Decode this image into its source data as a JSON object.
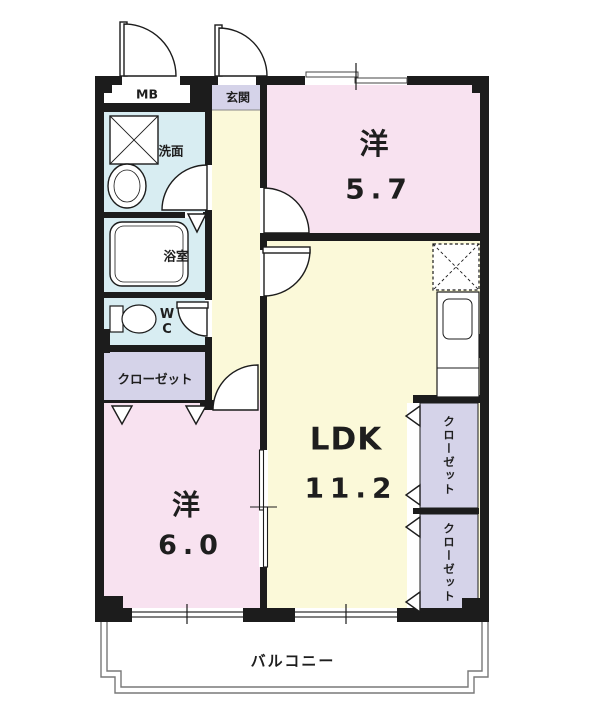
{
  "plan": {
    "title": "apartment floor plan",
    "rooms": {
      "bedroom_top": {
        "label": "洋",
        "size": "5.7"
      },
      "bedroom_bottom": {
        "label": "洋",
        "size": "6.0"
      },
      "ldk": {
        "label": "LDK",
        "size": "11.2"
      },
      "entrance": {
        "label": "玄関"
      },
      "washroom": {
        "label": "洗面"
      },
      "bathroom": {
        "label": "浴室"
      },
      "toilet": {
        "label": "W\nC"
      },
      "meter_box": {
        "label": "MB"
      },
      "hall_closet": {
        "label": "クローゼット"
      },
      "right_closet_top": {
        "label": "クローゼット"
      },
      "right_closet_bottom": {
        "label": "クローゼット"
      },
      "balcony": {
        "label": "バルコニー"
      }
    },
    "colors": {
      "wall": "#1c1c1c",
      "bedroom": "#f8e2f0",
      "living": "#fbf9d9",
      "wet_area": "#d8edf2",
      "closet": "#d5d3e9",
      "white": "#ffffff",
      "outline": "#787878"
    }
  }
}
